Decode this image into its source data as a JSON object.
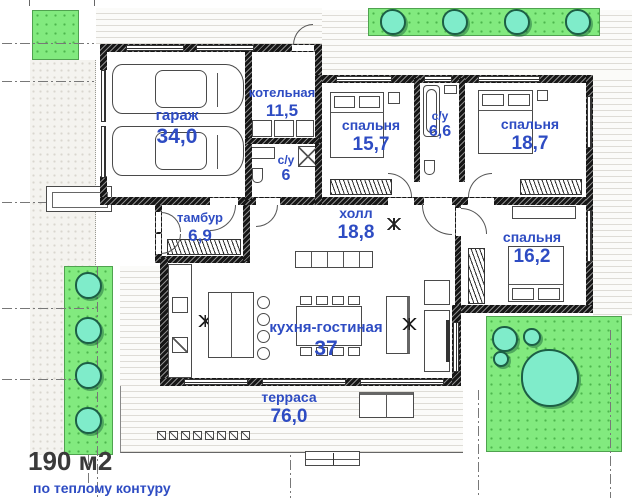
{
  "plan": {
    "type": "floor-plan",
    "footer": {
      "total": "190 м2",
      "note": "по теплому контуру"
    },
    "rooms": [
      {
        "id": "garage",
        "name": "гараж",
        "area": "34,0"
      },
      {
        "id": "boiler-room",
        "name": "котельная",
        "area": "11,5"
      },
      {
        "id": "bathroom-1",
        "name": "с/у",
        "area": "6"
      },
      {
        "id": "bedroom-1",
        "name": "спальня",
        "area": "15,7"
      },
      {
        "id": "bathroom-2",
        "name": "с/у",
        "area": "6,6"
      },
      {
        "id": "bedroom-2",
        "name": "спальня",
        "area": "18,7"
      },
      {
        "id": "vestibule",
        "name": "тамбур",
        "area": "6,9"
      },
      {
        "id": "hall",
        "name": "холл",
        "area": "18,8"
      },
      {
        "id": "bedroom-3",
        "name": "спальня",
        "area": "16,2"
      },
      {
        "id": "kitchen-living",
        "name": "кухня-гостиная",
        "area": "37"
      },
      {
        "id": "terrace",
        "name": "терраса",
        "area": "76,0"
      }
    ],
    "colors": {
      "label_blue": "#2e4cc3",
      "lawn_green": "#82ea7f",
      "tree_teal": "#7fecca",
      "wall_dark": "#161616",
      "paving_gray": "#dedcd6"
    }
  }
}
